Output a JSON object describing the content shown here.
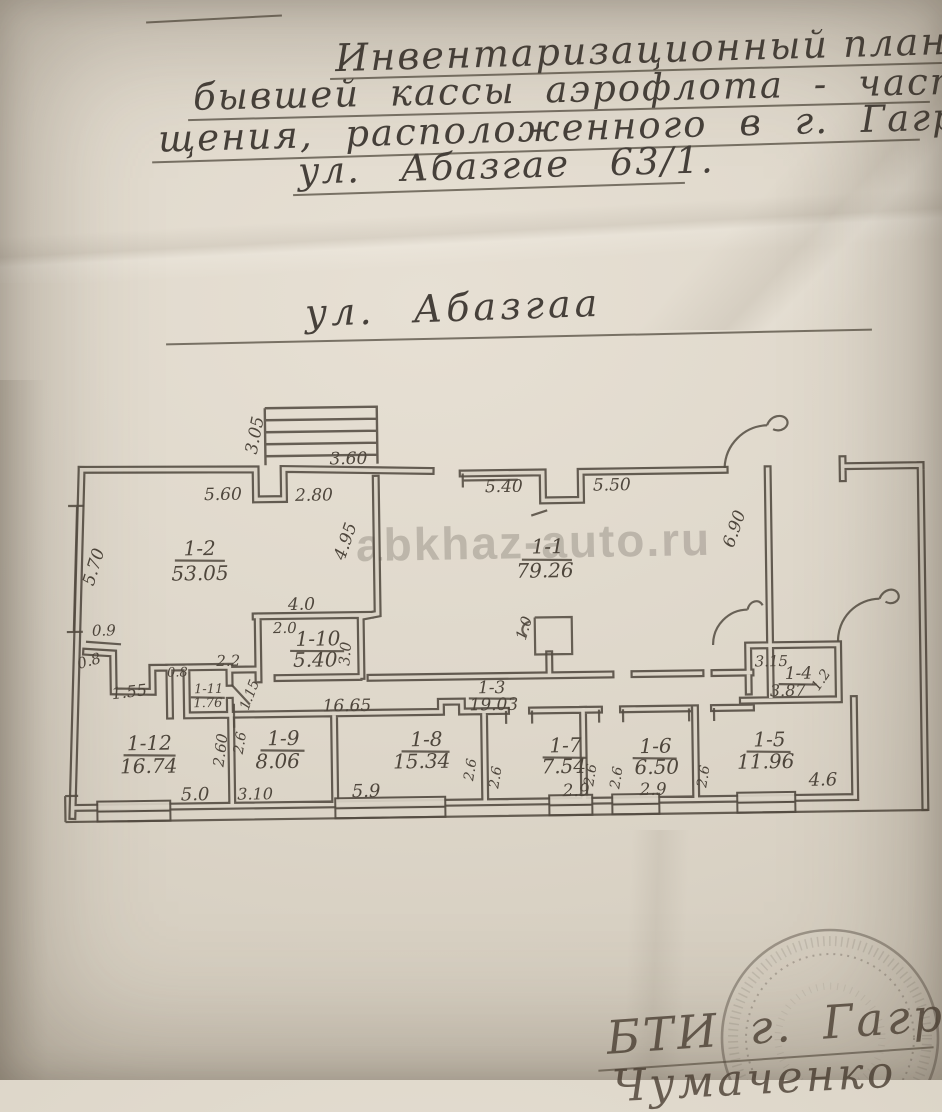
{
  "photo": {
    "title_lines": [
      "Инвентаризационный план здан",
      "бывшей кассы аэрофлота - часть поме",
      "щения, расположенного в г. Гагра по",
      "ул. Абазгае 63/1."
    ],
    "street_label": "ул. Абазгаа",
    "watermark": "abkhaz-auto.ru",
    "stamp_text": "БТИ г. Гагра",
    "stamp_signature": "Чумаченко"
  },
  "plan": {
    "ink_color": "#50483e",
    "paper_color": "#d9d2c6",
    "rooms": [
      {
        "id": "1-2",
        "area": "53.05"
      },
      {
        "id": "1-1",
        "area": "79.26"
      },
      {
        "id": "1-10",
        "area": "5.40"
      },
      {
        "id": "1-3",
        "area": "19.03"
      },
      {
        "id": "1-4",
        "area": "3.87"
      },
      {
        "id": "1-12",
        "area": "16.74"
      },
      {
        "id": "1-11",
        "area": "1.76"
      },
      {
        "id": "1-9",
        "area": "8.06"
      },
      {
        "id": "1-8",
        "area": "15.34"
      },
      {
        "id": "1-7",
        "area": "7.54"
      },
      {
        "id": "1-6",
        "area": "6.50"
      },
      {
        "id": "1-5",
        "area": "11.96"
      }
    ],
    "dims": [
      "5.60",
      "2.80",
      "3.05",
      "3.60",
      "5.70",
      "4.95",
      "5.40",
      "5.50",
      "6.90",
      "4.0",
      "2.0",
      "3.0",
      "16.65",
      "0.9",
      "0.8",
      "1.55",
      "0.8",
      "2.2",
      "1.15",
      "2.60",
      "5.0",
      "2.6",
      "3.10",
      "5.9",
      "2.6",
      "2.6",
      "2.9",
      "2.6",
      "2.6",
      "2.9",
      "2.6",
      "4.6",
      "3.15",
      "1.2",
      "1.0"
    ]
  }
}
